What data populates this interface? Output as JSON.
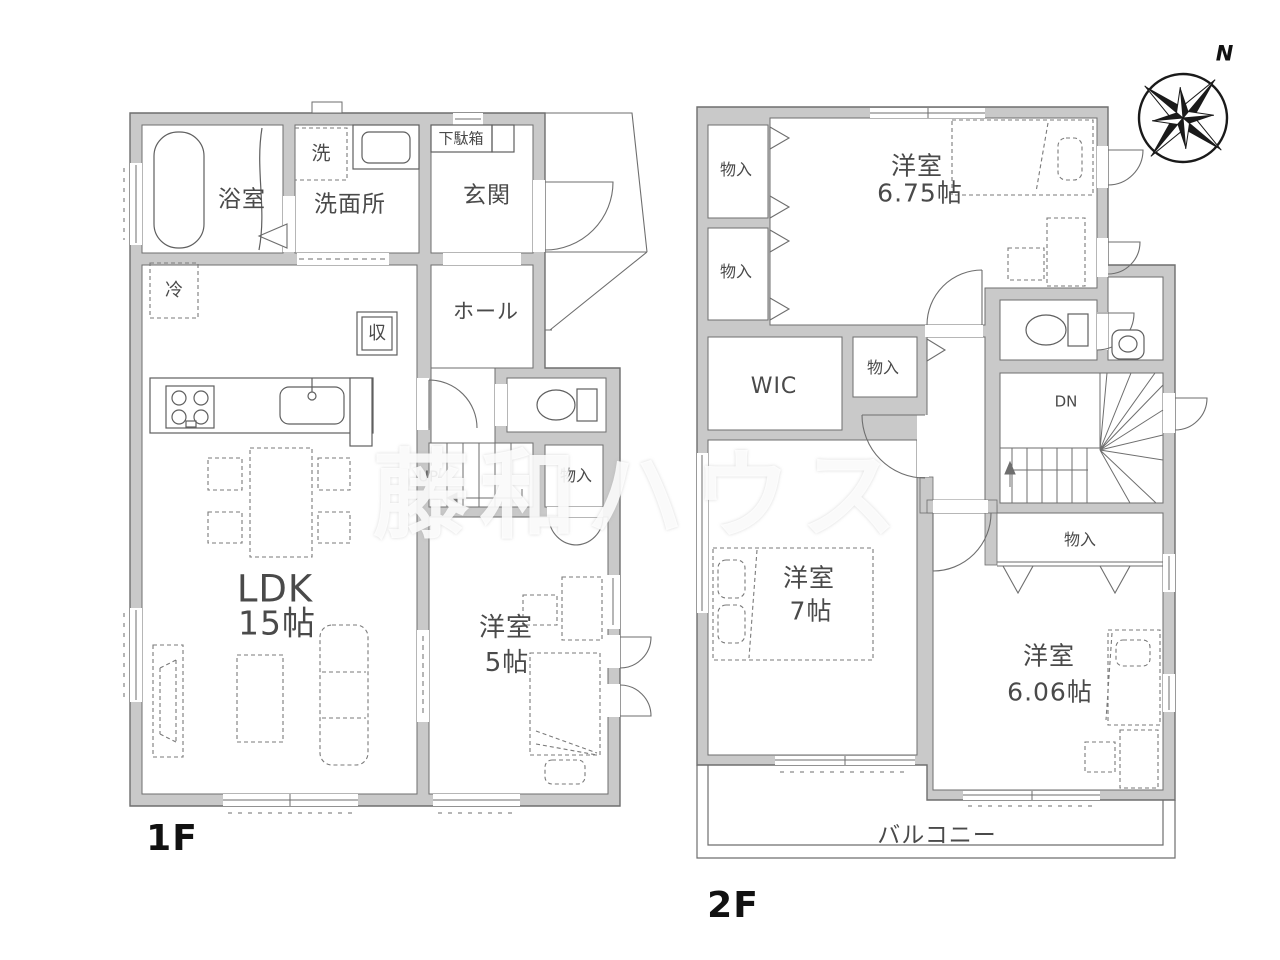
{
  "colors": {
    "wall_fill": "#c9c9c9",
    "wall_line": "#6e6e6e",
    "fixture_line": "#5f5f5f",
    "furniture_line": "#7a7a7a",
    "label_text": "#4a4a4a",
    "floor_label_text": "#111111",
    "watermark_text": "rgba(255,255,255,0.85)"
  },
  "floor1": {
    "label": "1F",
    "rooms": {
      "bath": "浴室",
      "laundry": "洗",
      "washroom": "洗面所",
      "shoe_cabinet": "下駄箱",
      "entrance": "玄関",
      "hall": "ホール",
      "refrigerator": "冷",
      "storage": "収",
      "ldk_name": "LDK",
      "ldk_size": "15帖",
      "stairs_direction": "UP",
      "closet": "物入",
      "bedroom_name": "洋室",
      "bedroom_size": "5帖"
    }
  },
  "floor2": {
    "label": "2F",
    "rooms": {
      "closet_top_1": "物入",
      "closet_top_2": "物入",
      "bedroom675_name": "洋室",
      "bedroom675_size": "6.75帖",
      "wic": "WIC",
      "closet_center": "物入",
      "stairs_direction": "DN",
      "closet_right": "物入",
      "bedroom7_name": "洋室",
      "bedroom7_size": "7帖",
      "bedroom606_name": "洋室",
      "bedroom606_size": "6.06帖",
      "balcony": "バルコニー"
    }
  },
  "compass": {
    "north": "N"
  },
  "watermark": "藤和ハウス"
}
